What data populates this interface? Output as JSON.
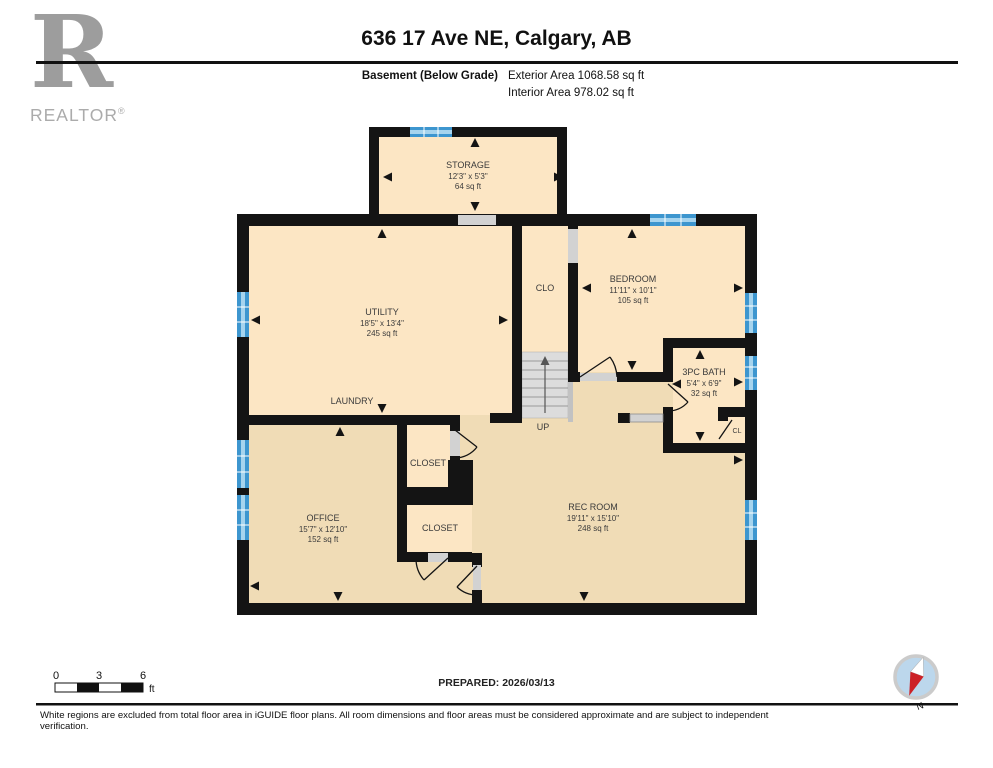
{
  "header": {
    "logo": {
      "letter": "R",
      "brand": "REALTOR",
      "registered": "®"
    },
    "title": "636 17 Ave NE, Calgary, AB",
    "floor_label": "Basement (Below Grade)",
    "exterior_area": "Exterior Area 1068.58 sq ft",
    "interior_area": "Interior Area 978.02 sq ft"
  },
  "plan": {
    "rooms": {
      "storage": {
        "name": "STORAGE",
        "dims": "12'3\" x 5'3\"",
        "area": "64 sq ft"
      },
      "utility": {
        "name": "UTILITY",
        "dims": "18'5\" x 13'4\"",
        "area": "245 sq ft"
      },
      "laundry": {
        "name": "LAUNDRY"
      },
      "clo": {
        "name": "CLO"
      },
      "bedroom": {
        "name": "BEDROOM",
        "dims": "11'11\" x 10'1\"",
        "area": "105 sq ft"
      },
      "bath": {
        "name": "3PC BATH",
        "dims": "5'4\" x 6'9\"",
        "area": "32 sq ft"
      },
      "cl": {
        "name": "CL"
      },
      "closet_upper": {
        "name": "CLOSET"
      },
      "closet_lower": {
        "name": "CLOSET"
      },
      "office": {
        "name": "OFFICE",
        "dims": "15'7\" x 12'10\"",
        "area": "152 sq ft"
      },
      "rec_room": {
        "name": "REC ROOM",
        "dims": "19'11\" x 15'10\"",
        "area": "248 sq ft"
      },
      "stairs": {
        "label": "UP"
      }
    }
  },
  "footer": {
    "scale_bar": {
      "tick_0": "0",
      "tick_3": "3",
      "tick_6": "6",
      "unit": "ft"
    },
    "prepared": "PREPARED: 2026/03/13",
    "compass": {
      "label": "N"
    },
    "disclaimer": "White regions are excluded from total floor area in iGUIDE floor plans. All room dimensions and floor areas must be considered approximate and are subject to independent verification."
  },
  "colors": {
    "wall": "#141414",
    "room_light": "#FCE6C4",
    "room_dark": "#F0DCB6",
    "window_blue": "#3D96CF",
    "window_blue_light": "#A6D4EE",
    "stair_gray": "#DCDCDC",
    "threshold_gray": "#D2D2D2",
    "compass_fill": "#BCD7EC",
    "compass_red": "#CC2127",
    "logo_gray": "#9D9D9D"
  }
}
